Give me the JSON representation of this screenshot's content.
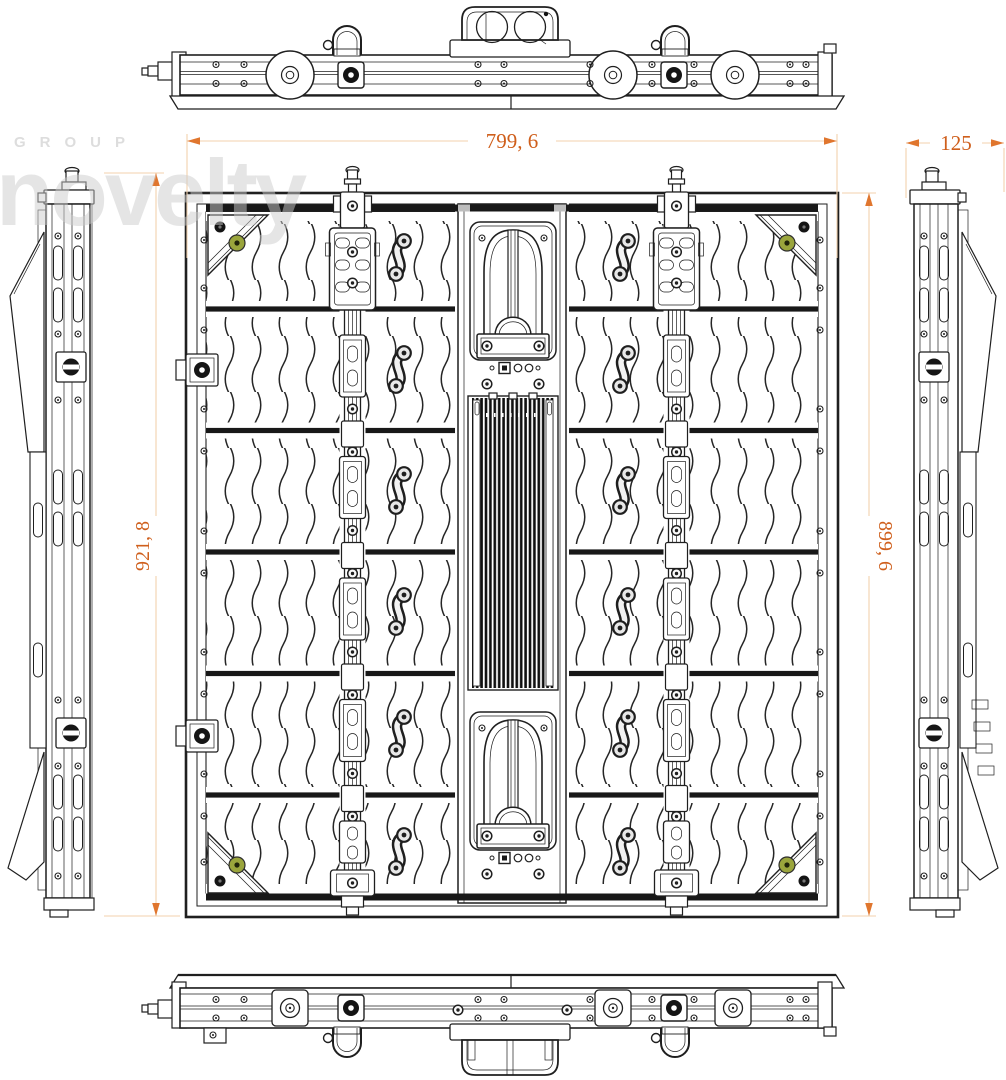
{
  "page": {
    "title": "LED panel cabinet engineering drawing",
    "background": "#ffffff"
  },
  "watermark": {
    "group_label": "GROUP",
    "brand": "novelty"
  },
  "dimensions": {
    "top_width": {
      "label": "799, 6",
      "orientation": "horizontal"
    },
    "left_height": {
      "label": "921, 8",
      "orientation": "vertical"
    },
    "right_height": {
      "label": "899, 6",
      "orientation": "vertical"
    },
    "side_depth": {
      "label": "125",
      "orientation": "horizontal"
    }
  },
  "views": {
    "top": {
      "name": "top view"
    },
    "rear": {
      "name": "rear view",
      "module_rows": 6,
      "handles_per_row": 2,
      "corner_brackets": 4,
      "vertical_rails": 2
    },
    "left": {
      "name": "left side view"
    },
    "right": {
      "name": "right side view"
    },
    "bottom": {
      "name": "bottom view"
    }
  },
  "colors": {
    "line": "#1f1f1f",
    "dim_text": "#cf5f1c",
    "dim_line": "#f3d2ae",
    "dim_arrow": "#e0762e",
    "accent_green": "#9aa53c",
    "watermark": "#cccccc",
    "background": "#ffffff"
  }
}
